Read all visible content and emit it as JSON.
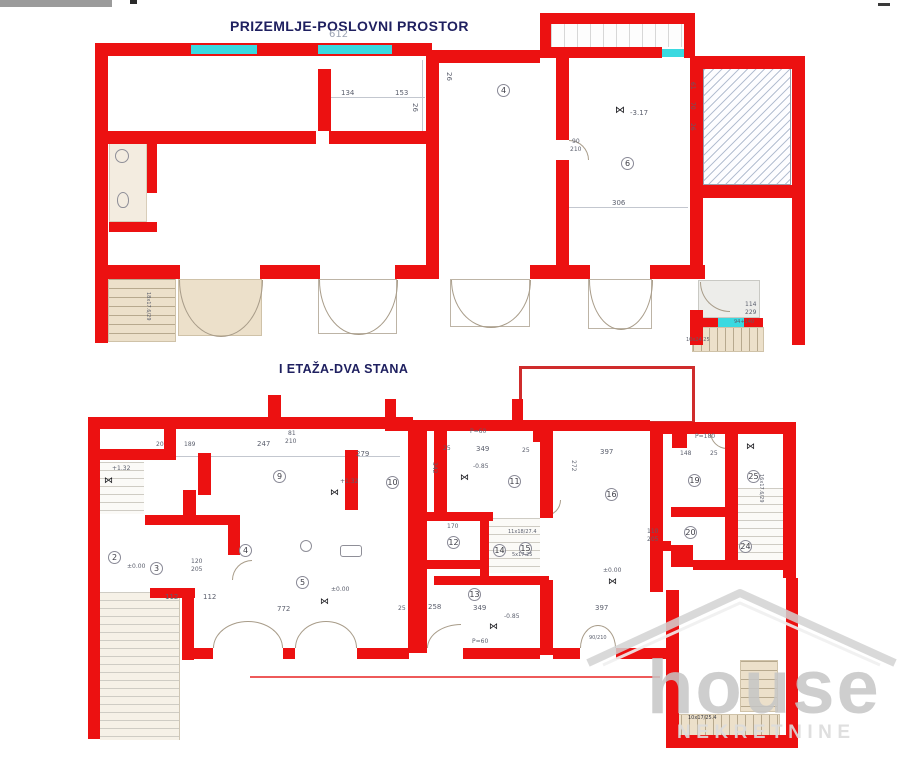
{
  "titles": {
    "ground_floor": "PRIZEMLJE-POSLOVNI PROSTOR",
    "first_floor": "I ETAŽA-DVA STANA"
  },
  "watermark": {
    "brand": "house",
    "subtitle": "NEKRETNINE"
  },
  "colors": {
    "wall_red": "#ec1111",
    "window_cyan": "#3ad9e0",
    "title_navy": "#1f2060",
    "watermark_gray": "#c6c6c6"
  },
  "ground_floor": {
    "labels": [
      {
        "t": "612",
        "x": 329,
        "y": 30,
        "s": 10,
        "c": "#9aa2b2"
      },
      {
        "t": "134",
        "x": 341,
        "y": 90,
        "s": 7
      },
      {
        "t": "153",
        "x": 395,
        "y": 90,
        "s": 7
      },
      {
        "t": "26",
        "x": 418,
        "y": 103,
        "s": 7,
        "r": 90
      },
      {
        "t": "26",
        "x": 452,
        "y": 72,
        "s": 7,
        "r": 90
      },
      {
        "t": "4",
        "x": 497,
        "y": 84,
        "circ": true
      },
      {
        "t": "90",
        "x": 572,
        "y": 139,
        "s": 6
      },
      {
        "t": "210",
        "x": 570,
        "y": 147,
        "s": 6
      },
      {
        "t": "⋈",
        "x": 615,
        "y": 106,
        "s": 10,
        "c": "#15151a"
      },
      {
        "t": "-3.17",
        "x": 630,
        "y": 110,
        "s": 7
      },
      {
        "t": "6",
        "x": 621,
        "y": 157,
        "circ": true
      },
      {
        "t": "306",
        "x": 612,
        "y": 200,
        "s": 7
      },
      {
        "t": "61",
        "x": 695,
        "y": 82,
        "s": 6,
        "r": 90
      },
      {
        "t": "70",
        "x": 695,
        "y": 102,
        "s": 6,
        "r": 90
      },
      {
        "t": "26",
        "x": 695,
        "y": 123,
        "s": 6,
        "r": 90
      },
      {
        "t": "114",
        "x": 745,
        "y": 302,
        "s": 6
      },
      {
        "t": "229",
        "x": 745,
        "y": 310,
        "s": 6
      },
      {
        "t": "94+140",
        "x": 734,
        "y": 320,
        "s": 5
      },
      {
        "t": "10x24.25",
        "x": 686,
        "y": 338,
        "s": 5
      },
      {
        "t": "18x17.6/29",
        "x": 150,
        "y": 292,
        "s": 5,
        "r": 90
      }
    ]
  },
  "first_floor": {
    "labels": [
      {
        "t": "20",
        "x": 156,
        "y": 442,
        "s": 6
      },
      {
        "t": "189",
        "x": 184,
        "y": 442,
        "s": 6
      },
      {
        "t": "247",
        "x": 257,
        "y": 441,
        "s": 7
      },
      {
        "t": "81",
        "x": 288,
        "y": 431,
        "s": 6
      },
      {
        "t": "210",
        "x": 285,
        "y": 439,
        "s": 6
      },
      {
        "t": "279",
        "x": 356,
        "y": 451,
        "s": 7
      },
      {
        "t": "+1.32",
        "x": 112,
        "y": 466,
        "s": 6
      },
      {
        "t": "⋈",
        "x": 104,
        "y": 477,
        "s": 9,
        "c": "#15151a"
      },
      {
        "t": "9",
        "x": 273,
        "y": 470,
        "circ": true
      },
      {
        "t": "+1.32",
        "x": 340,
        "y": 479,
        "s": 6
      },
      {
        "t": "⋈",
        "x": 330,
        "y": 489,
        "s": 9,
        "c": "#15151a"
      },
      {
        "t": "10",
        "x": 386,
        "y": 476,
        "circ": true
      },
      {
        "t": "P=60",
        "x": 470,
        "y": 429,
        "s": 6
      },
      {
        "t": "25",
        "x": 443,
        "y": 446,
        "s": 6
      },
      {
        "t": "349",
        "x": 476,
        "y": 446,
        "s": 7
      },
      {
        "t": "25",
        "x": 522,
        "y": 448,
        "s": 6
      },
      {
        "t": "342",
        "x": 437,
        "y": 462,
        "s": 6,
        "r": 90
      },
      {
        "t": "-0.85",
        "x": 473,
        "y": 464,
        "s": 6
      },
      {
        "t": "⋈",
        "x": 460,
        "y": 474,
        "s": 9,
        "c": "#15151a"
      },
      {
        "t": "11",
        "x": 508,
        "y": 475,
        "circ": true
      },
      {
        "t": "397",
        "x": 600,
        "y": 449,
        "s": 7
      },
      {
        "t": "272",
        "x": 576,
        "y": 460,
        "s": 6,
        "r": 90
      },
      {
        "t": "16",
        "x": 605,
        "y": 488,
        "circ": true
      },
      {
        "t": "P=180",
        "x": 695,
        "y": 434,
        "s": 6
      },
      {
        "t": "148",
        "x": 680,
        "y": 451,
        "s": 6
      },
      {
        "t": "25",
        "x": 710,
        "y": 451,
        "s": 6
      },
      {
        "t": "⋈",
        "x": 746,
        "y": 443,
        "s": 9,
        "c": "#15151a"
      },
      {
        "t": "19",
        "x": 688,
        "y": 474,
        "circ": true
      },
      {
        "t": "25",
        "x": 747,
        "y": 470,
        "circ": true
      },
      {
        "t": "16x17.6/29",
        "x": 763,
        "y": 474,
        "s": 5,
        "r": 90
      },
      {
        "t": "170",
        "x": 447,
        "y": 524,
        "s": 6
      },
      {
        "t": "11x18/27.4",
        "x": 508,
        "y": 530,
        "s": 5
      },
      {
        "t": "12",
        "x": 447,
        "y": 536,
        "circ": true
      },
      {
        "t": "14",
        "x": 493,
        "y": 544,
        "circ": true
      },
      {
        "t": "15",
        "x": 519,
        "y": 542,
        "circ": true
      },
      {
        "t": "5x17.25",
        "x": 512,
        "y": 553,
        "s": 5
      },
      {
        "t": "110",
        "x": 647,
        "y": 529,
        "s": 6
      },
      {
        "t": "205",
        "x": 647,
        "y": 537,
        "s": 6
      },
      {
        "t": "20",
        "x": 684,
        "y": 526,
        "circ": true
      },
      {
        "t": "24",
        "x": 739,
        "y": 540,
        "circ": true
      },
      {
        "t": "2",
        "x": 108,
        "y": 551,
        "circ": true
      },
      {
        "t": "3",
        "x": 150,
        "y": 562,
        "circ": true
      },
      {
        "t": "4",
        "x": 239,
        "y": 544,
        "circ": true
      },
      {
        "t": "120",
        "x": 191,
        "y": 559,
        "s": 6
      },
      {
        "t": "205",
        "x": 191,
        "y": 567,
        "s": 6
      },
      {
        "t": "±0.00",
        "x": 127,
        "y": 564,
        "s": 6
      },
      {
        "t": "5",
        "x": 296,
        "y": 576,
        "circ": true
      },
      {
        "t": "±0.00",
        "x": 331,
        "y": 587,
        "s": 6
      },
      {
        "t": "⋈",
        "x": 320,
        "y": 598,
        "s": 9,
        "c": "#15151a"
      },
      {
        "t": "112",
        "x": 165,
        "y": 594,
        "s": 7
      },
      {
        "t": "112",
        "x": 203,
        "y": 594,
        "s": 7
      },
      {
        "t": "772",
        "x": 277,
        "y": 606,
        "s": 7
      },
      {
        "t": "±0.00",
        "x": 603,
        "y": 568,
        "s": 6
      },
      {
        "t": "⋈",
        "x": 608,
        "y": 578,
        "s": 9,
        "c": "#15151a"
      },
      {
        "t": "25",
        "x": 398,
        "y": 606,
        "s": 6
      },
      {
        "t": "258",
        "x": 428,
        "y": 604,
        "s": 7
      },
      {
        "t": "349",
        "x": 473,
        "y": 605,
        "s": 7
      },
      {
        "t": "397",
        "x": 595,
        "y": 605,
        "s": 7
      },
      {
        "t": "-0.85",
        "x": 504,
        "y": 614,
        "s": 6
      },
      {
        "t": "⋈",
        "x": 489,
        "y": 623,
        "s": 9,
        "c": "#15151a"
      },
      {
        "t": "13",
        "x": 468,
        "y": 588,
        "circ": true
      },
      {
        "t": "P=60",
        "x": 472,
        "y": 639,
        "s": 6
      },
      {
        "t": "90/210",
        "x": 589,
        "y": 636,
        "s": 5
      },
      {
        "t": "10x17/25.4",
        "x": 688,
        "y": 716,
        "s": 5,
        "c": "#3a3a40"
      }
    ]
  }
}
